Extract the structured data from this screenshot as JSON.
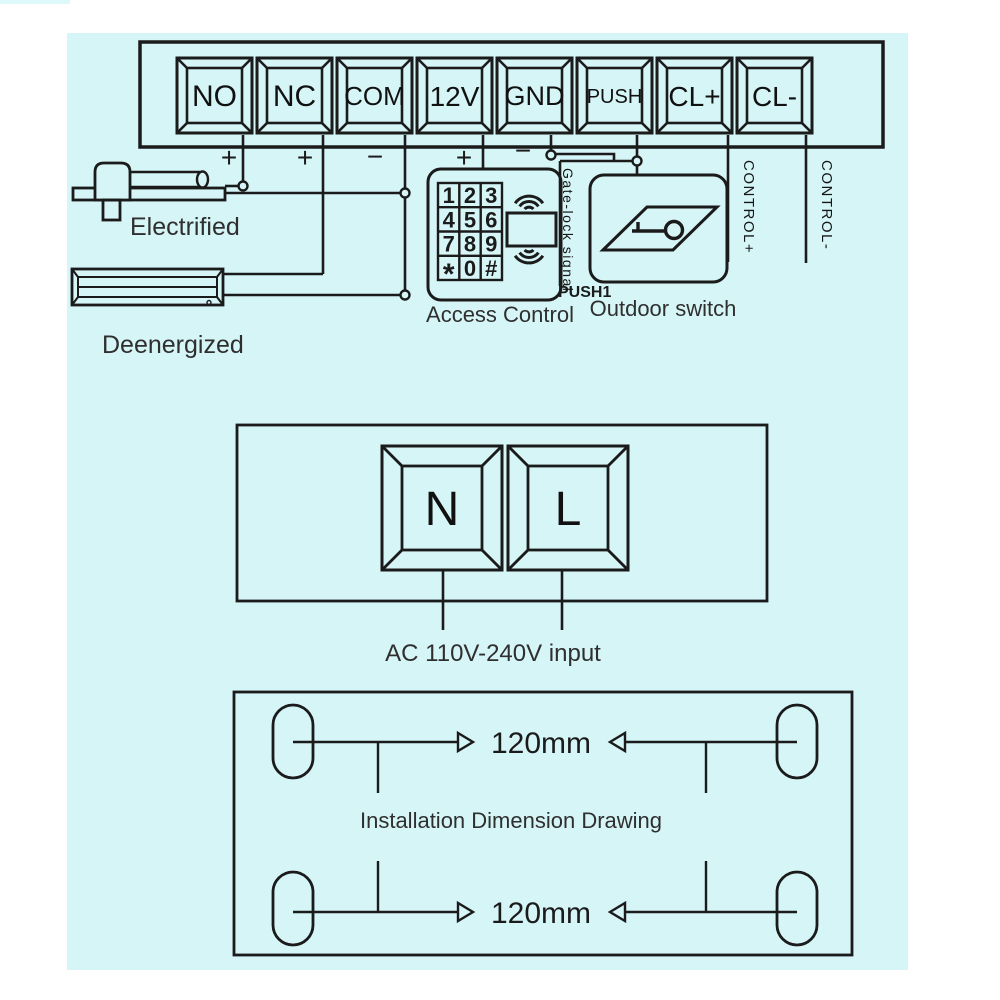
{
  "colors": {
    "canvas": "#d6f5f7",
    "line": "#1b1b1b"
  },
  "terminal_strip": {
    "terminals": [
      {
        "label": "NO",
        "sign": "+"
      },
      {
        "label": "NC",
        "sign": "+"
      },
      {
        "label": "COM",
        "sign": "−"
      },
      {
        "label": "12V",
        "sign": "+"
      },
      {
        "label": "GND",
        "sign": "−"
      },
      {
        "label": "PUSH"
      },
      {
        "label": "CL+"
      },
      {
        "label": "CL-"
      }
    ]
  },
  "locks": {
    "electrified_label": "Electrified",
    "deenergized_label": "Deenergized"
  },
  "access_control": {
    "label": "Access Control",
    "keypad": [
      [
        "1",
        "2",
        "3"
      ],
      [
        "4",
        "5",
        "6"
      ],
      [
        "7",
        "8",
        "9"
      ],
      [
        "*",
        "0",
        "#"
      ]
    ],
    "signal_label": "Gate-lock signal",
    "push_label": "PUSH1"
  },
  "outdoor_switch": {
    "label": "Outdoor switch"
  },
  "control_wires": {
    "plus": "CONTROL+",
    "minus": "CONTROL-"
  },
  "power_input": {
    "terminals": [
      "N",
      "L"
    ],
    "label": "AC 110V-240V input"
  },
  "dimension_drawing": {
    "title": "Installation Dimension Drawing",
    "top_dimension": "120mm",
    "bottom_dimension": "120mm"
  }
}
